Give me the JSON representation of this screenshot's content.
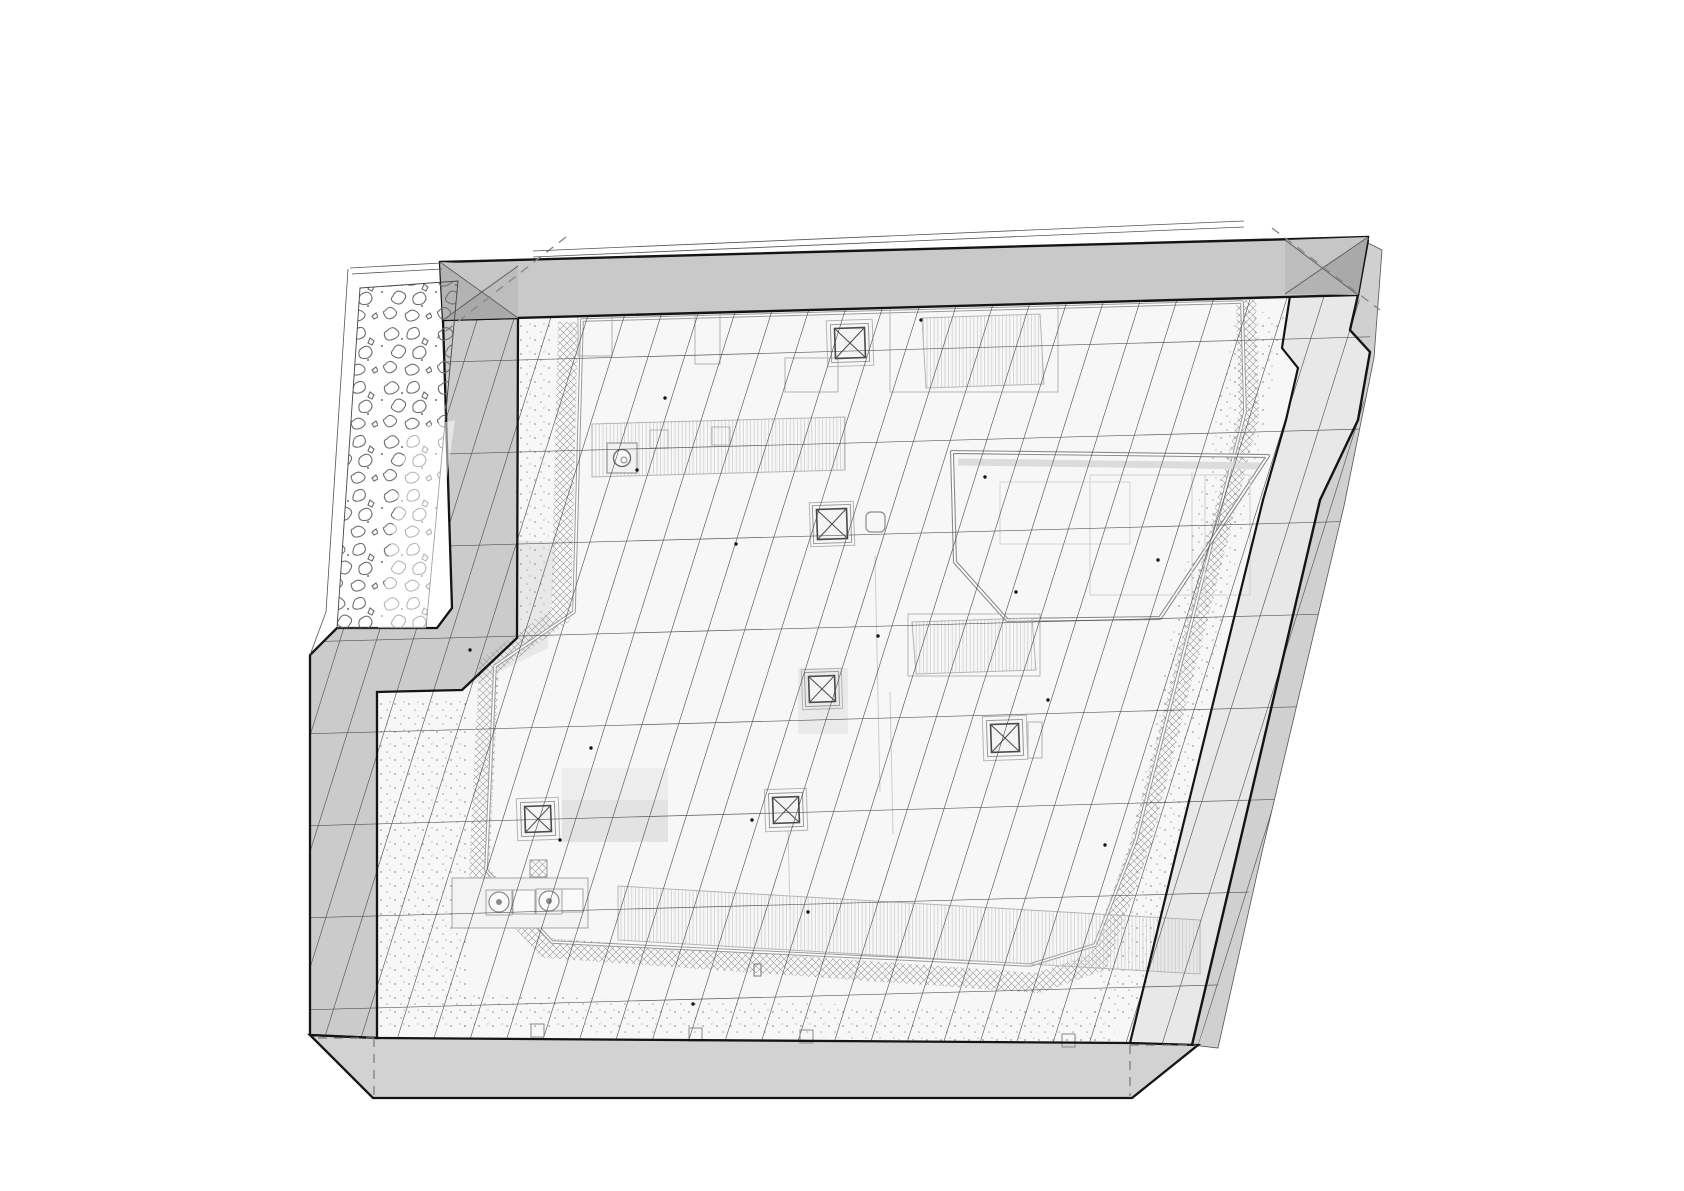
{
  "canvas": {
    "w": 1684,
    "h": 1191,
    "bg": "#ffffff"
  },
  "palette": {
    "outline": "#141414",
    "band_top": "#c9c9c9",
    "band_left": "#cbcbcb",
    "band_bottom": "#d2d2d2",
    "band_right": "#e8e8e8",
    "band_right_outer": "#d0d0d0",
    "field": "#f7f7f7",
    "tint": "#e8e8e8",
    "corner_dark": "#a9a9a9",
    "corner_mid": "#b3b3b3",
    "corner_light": "#c6c6c6",
    "grid_line": "#3f3f3f",
    "equip_line": "#b0b0b0",
    "crosshatch": "#969696",
    "speckle": "#9b9b9b",
    "veg_stroke": "#6e6e6e",
    "hidden_dash": "#777777",
    "double_line": "#8a8a8a"
  },
  "grid": {
    "clip": "443,320 518,318 1358,295 1374,350 1344,505 1262,852 1198,1046 1130,1043 375,1038 310,1035 310,655 337,628 437,628 452,608"
  },
  "layers": [
    {
      "name": "roof-field",
      "kind": "poly",
      "pts": "518,318 1290,296 1282,348 1298,368 1286,420 1263,500 1177,850 1130,1043 375,1038 377,692 462,690 517,638",
      "fill": "#f7f7f7"
    },
    {
      "name": "right-parapet-band",
      "kind": "poly",
      "pts": "1290,296 1358,295 1350,330 1370,352 1358,420 1320,500 1238,850 1192,1045 1130,1043 1177,850 1263,500 1286,420 1298,368 1282,348",
      "fill": "#e8e8e8"
    },
    {
      "name": "right-outer-wall-strip",
      "kind": "poly",
      "pts": "1358,295 1368,243 1382,250 1374,358 1344,506 1262,852 1218,1048 1192,1045 1238,850 1320,500 1358,420 1370,352 1350,330",
      "fill": "#d0d0d0",
      "stroke": "#555555",
      "sw": 0.8
    },
    {
      "name": "left-parapet-band",
      "kind": "poly",
      "pts": "443,320 518,318 517,638 462,690 377,692 377,1038 310,1035 310,655 337,628 437,628 452,608",
      "fill": "#cbcbcb"
    },
    {
      "name": "bottom-parapet-band",
      "kind": "poly",
      "pts": "310,1035 377,1038 1130,1043 1198,1045 1132,1098 373,1098",
      "fill": "#d2d2d2"
    },
    {
      "name": "field-tint-step",
      "kind": "poly",
      "pts": "517,540 556,542 548,648 462,690 517,638",
      "fill": "#e8e8e8"
    },
    {
      "name": "gravel-speckle-band",
      "kind": "path",
      "items": [
        {
          "d": "M536,322 L530,620",
          "stroke": "url(#spk)",
          "sw": 34
        },
        {
          "d": "M422,700 L424,1028",
          "stroke": "url(#spk)",
          "sw": 88
        },
        {
          "d": "M460,1012 L1115,1028",
          "stroke": "url(#spk)",
          "sw": 34
        },
        {
          "d": "M1262,312 L1152,850 L1114,1020",
          "stroke": "url(#spk)",
          "sw": 48,
          "join": "round"
        }
      ]
    },
    {
      "name": "drainage-crosshatch-strip",
      "kind": "path",
      "items": [
        {
          "d": "M568,322 L561,615 L489,666 L479,872 L546,948 L1038,983 L1098,962 L1140,845 L1249,415 L1246,300",
          "stroke": "url(#xh)",
          "sw": 20,
          "join": "round"
        }
      ]
    },
    {
      "name": "paver-field-edge",
      "kind": "dbl",
      "d": "M582,320 L574,612 L495,666 L486,870 L552,942 L1030,965 L1095,945 L1136,840 L1245,412 L1242,302 Z",
      "c1": "#9a9a9a",
      "w1": 3.6,
      "c2": "#ffffff",
      "w2": 1.6
    },
    {
      "name": "upper-roof-shadow",
      "kind": "path",
      "items": [
        {
          "d": "M958,462 L1262,466",
          "stroke": "#dcdcdc",
          "sw": 7
        }
      ]
    },
    {
      "name": "upper-roof-outline",
      "kind": "dbl",
      "d": "M952,452 L1268,456 L1160,618 L1007,620 L955,562 Z",
      "c1": "#8a8a8a",
      "w1": 4,
      "c2": "#ffffff",
      "w2": 1.8
    },
    {
      "name": "upper-roof-equipment",
      "kind": "rects",
      "items": [
        [
          1090,
          475,
          160,
          120,
          0,
          "#cfcfcf",
          null,
          1
        ],
        [
          1000,
          482,
          130,
          62,
          0,
          "#d4d4d4",
          null,
          1
        ]
      ]
    },
    {
      "name": "upper-roof-equipment-lines",
      "kind": "lines",
      "items": [
        [
          1192,
          472,
          1192,
          610
        ],
        [
          1205,
          474,
          1205,
          610
        ]
      ],
      "stroke": "#cfcfcf",
      "sw": 1
    },
    {
      "name": "equipment-pads",
      "kind": "rects",
      "items": [
        [
          562,
          768,
          106,
          74,
          0,
          null,
          "#ededed",
          0
        ],
        [
          562,
          800,
          106,
          42,
          0,
          null,
          "#e3e3e3",
          0
        ],
        [
          798,
          668,
          50,
          66,
          0,
          null,
          "#eaeaea",
          0
        ]
      ]
    },
    {
      "name": "louver-grilles",
      "kind": "poly",
      "items": [
        {
          "pts": "922,318 1040,314 1044,384 926,388",
          "fill": "url(#vh)",
          "stroke": "#b5b5b5",
          "sw": 1
        },
        {
          "pts": "592,424 845,417 845,470 592,477",
          "fill": "url(#vh)",
          "stroke": "#b5b5b5",
          "sw": 1
        },
        {
          "pts": "912,622 1032,618 1036,670 916,674",
          "fill": "url(#vh)",
          "stroke": "#b5b5b5",
          "sw": 1
        },
        {
          "pts": "618,886 1200,920 1200,974 618,940",
          "fill": "url(#vh)",
          "stroke": "#b5b5b5",
          "sw": 1
        }
      ]
    },
    {
      "name": "equipment-outlines",
      "kind": "rects",
      "items": [
        [
          890,
          300,
          168,
          92,
          0,
          "#b5b5b5",
          null,
          1
        ],
        [
          908,
          614,
          132,
          62,
          0,
          "#b5b5b5",
          null,
          1
        ],
        [
          695,
          310,
          25,
          54,
          0,
          "#b0b0b0",
          null,
          1
        ],
        [
          578,
          308,
          34,
          48,
          0,
          "#b0b0b0",
          null,
          1
        ],
        [
          785,
          358,
          53,
          34,
          0,
          "#b0b0b0",
          null,
          1
        ],
        [
          1028,
          722,
          14,
          36,
          0,
          "#b0b0b0",
          null,
          1
        ],
        [
          650,
          430,
          18,
          18,
          0,
          "#b0b0b0",
          null,
          1
        ],
        [
          712,
          427,
          18,
          18,
          0,
          "#b0b0b0",
          null,
          1
        ],
        [
          866,
          512,
          19,
          20,
          5,
          "#8c8c8c",
          null,
          1.2
        ],
        [
          530,
          860,
          17,
          17,
          0,
          "#9a9a9a",
          "url(#xh)",
          1
        ]
      ]
    },
    {
      "name": "fan-unit",
      "kind": "fan",
      "box": [
        452,
        878,
        136,
        50
      ],
      "circles": [
        [
          499,
          902,
          10
        ],
        [
          549,
          901,
          10
        ]
      ],
      "frames": [
        [
          486,
          890,
          26,
          25
        ],
        [
          536,
          889,
          26,
          25
        ]
      ],
      "rects": [
        [
          513,
          890,
          22,
          24
        ],
        [
          562,
          889,
          21,
          23
        ]
      ]
    },
    {
      "name": "skylights",
      "kind": "skylights",
      "items": [
        {
          "cx": 850,
          "cy": 343,
          "i": 30,
          "o": 46
        },
        {
          "cx": 832,
          "cy": 524,
          "i": 30,
          "o": 44
        },
        {
          "cx": 822,
          "cy": 689,
          "i": 26,
          "o": 40
        },
        {
          "cx": 1005,
          "cy": 738,
          "i": 28,
          "o": 44
        },
        {
          "cx": 786,
          "cy": 810,
          "i": 26,
          "o": 42
        },
        {
          "cx": 538,
          "cy": 819,
          "i": 26,
          "o": 42
        }
      ]
    },
    {
      "name": "roof-vent",
      "kind": "vent",
      "cx": 622,
      "cy": 458,
      "r": 8.5,
      "box": 30
    },
    {
      "name": "faint-conduit-lines",
      "kind": "lines",
      "items": [
        [
          875,
          556,
          880,
          792
        ],
        [
          890,
          692,
          893,
          834
        ],
        [
          788,
          830,
          790,
          910
        ]
      ],
      "stroke": "#cccccc",
      "sw": 1
    },
    {
      "name": "paver-grid",
      "kind": "grid",
      "color": "#3f3f3f",
      "width": 0.65,
      "opacity": 0.85,
      "diag": {
        "x0": 120,
        "x1": 1280,
        "step": 36.5,
        "yb": 1108,
        "yt": 290,
        "lean": 257
      },
      "horiz": {
        "y0": 366,
        "y1": 1080,
        "step": 92,
        "x0": 300,
        "x1": 1400,
        "drop": -30
      }
    },
    {
      "name": "survey-dots",
      "kind": "dots",
      "r": 1.7,
      "fill": "#161616",
      "items": [
        [
          591,
          748
        ],
        [
          665,
          398
        ],
        [
          736,
          544
        ],
        [
          985,
          477
        ],
        [
          878,
          636
        ],
        [
          808,
          912
        ],
        [
          1048,
          700
        ],
        [
          693,
          1004
        ],
        [
          470,
          650
        ],
        [
          560,
          840
        ],
        [
          1105,
          845
        ],
        [
          1158,
          560
        ],
        [
          921,
          320
        ],
        [
          752,
          820
        ],
        [
          1016,
          592
        ],
        [
          637,
          470
        ]
      ]
    },
    {
      "name": "edge-drain-boxes",
      "kind": "squares",
      "s": 13,
      "stroke": "#8a8a8a",
      "items": [
        [
          531,
          1024
        ],
        [
          689,
          1028
        ],
        [
          800,
          1030
        ],
        [
          1062,
          1034
        ]
      ]
    },
    {
      "name": "small-marker",
      "kind": "rects",
      "items": [
        [
          754,
          964,
          7,
          12,
          0,
          "#777777",
          null,
          1
        ]
      ]
    },
    {
      "name": "main-outlines",
      "kind": "poly",
      "items": [
        {
          "pts": "443,320 518,318 517,638 462,690 377,692 377,1038 310,1035 310,655 337,628 437,628 452,608",
          "stroke": "#141414",
          "sw": 2.3
        },
        {
          "pts": "310,1035 377,1038 1130,1043 1198,1045 1132,1098 373,1098",
          "stroke": "#141414",
          "sw": 2.3
        }
      ]
    },
    {
      "name": "right-edge-outlines",
      "kind": "path",
      "items": [
        {
          "d": "M1290,296 L1282,348 L1298,368 L1286,420 L1263,500 L1177,850 L1130,1043",
          "stroke": "#141414",
          "sw": 2.2
        },
        {
          "d": "M1368,240 L1358,295 L1350,330 L1370,352 L1358,420 L1320,500 L1238,850 L1192,1045",
          "stroke": "#141414",
          "sw": 2.4
        }
      ]
    },
    {
      "name": "hidden-edge-dashes",
      "kind": "lines",
      "dash": "9 7",
      "stroke": "#777777",
      "sw": 1.2,
      "items": [
        [
          318,
          1038,
          374,
          1038
        ],
        [
          374,
          1038,
          374,
          1096
        ],
        [
          1130,
          1045,
          1130,
          1096
        ],
        [
          1130,
          1045,
          1196,
          1045
        ]
      ]
    },
    {
      "name": "top-parapet-band",
      "kind": "poly",
      "pts": "440,262 1368,237 1358,295 443,320",
      "fill": "#c9c9c9",
      "stroke": "#141414",
      "sw": 2.4
    },
    {
      "name": "corner-fold-markers",
      "kind": "poly",
      "items": [
        {
          "pts": "440,262 518,266 480,291",
          "fill": "#c6c6c6"
        },
        {
          "pts": "518,266 518,318 480,291",
          "fill": "#bdbdbd"
        },
        {
          "pts": "518,318 443,320 480,291",
          "fill": "#a9a9a9"
        },
        {
          "pts": "443,320 440,262 480,291",
          "fill": "#b3b3b3"
        },
        {
          "pts": "1285,240 1368,237 1324,266",
          "fill": "#c6c6c6"
        },
        {
          "pts": "1368,237 1358,295 1324,266",
          "fill": "#a9a9a9"
        },
        {
          "pts": "1358,295 1285,294 1324,266",
          "fill": "#b3b3b3"
        },
        {
          "pts": "1285,294 1285,240 1324,266",
          "fill": "#bdbdbd"
        }
      ]
    },
    {
      "name": "corner-fold-lines",
      "kind": "lines",
      "stroke": "#555555",
      "sw": 0.8,
      "items": [
        [
          440,
          262,
          518,
          318
        ],
        [
          518,
          266,
          443,
          320
        ],
        [
          1285,
          240,
          1358,
          295
        ],
        [
          1368,
          237,
          1285,
          294
        ]
      ]
    },
    {
      "name": "corner-fold-dashes",
      "kind": "lines",
      "dash": "9 7",
      "stroke": "#8a8a8a",
      "sw": 1.4,
      "items": [
        [
          566,
          237,
          437,
          338
        ],
        [
          1272,
          228,
          1380,
          310
        ]
      ]
    },
    {
      "name": "coping-lines",
      "kind": "lines",
      "stroke": "#555555",
      "sw": 0.8,
      "items": [
        [
          533,
          251,
          1244,
          221
        ],
        [
          533,
          257,
          1244,
          227
        ]
      ]
    },
    {
      "name": "left-strip-lines",
      "kind": "lines",
      "stroke": "#555555",
      "sw": 0.8,
      "items": [
        [
          350,
          268,
          441,
          263
        ],
        [
          352,
          274,
          442,
          269
        ],
        [
          348,
          269,
          326,
          612
        ],
        [
          326,
          612,
          310,
          655
        ]
      ]
    },
    {
      "name": "planting-strip",
      "kind": "poly",
      "pts": "360,288 458,281 426,628 337,628",
      "fill": "url(#veg)",
      "stroke": "#444444",
      "sw": 0.9
    },
    {
      "name": "planting-strip-light-wash",
      "kind": "poly",
      "pts": "408,430 455,420 426,628 378,628",
      "fill": "#ffffff",
      "opacity": 0.5
    }
  ]
}
